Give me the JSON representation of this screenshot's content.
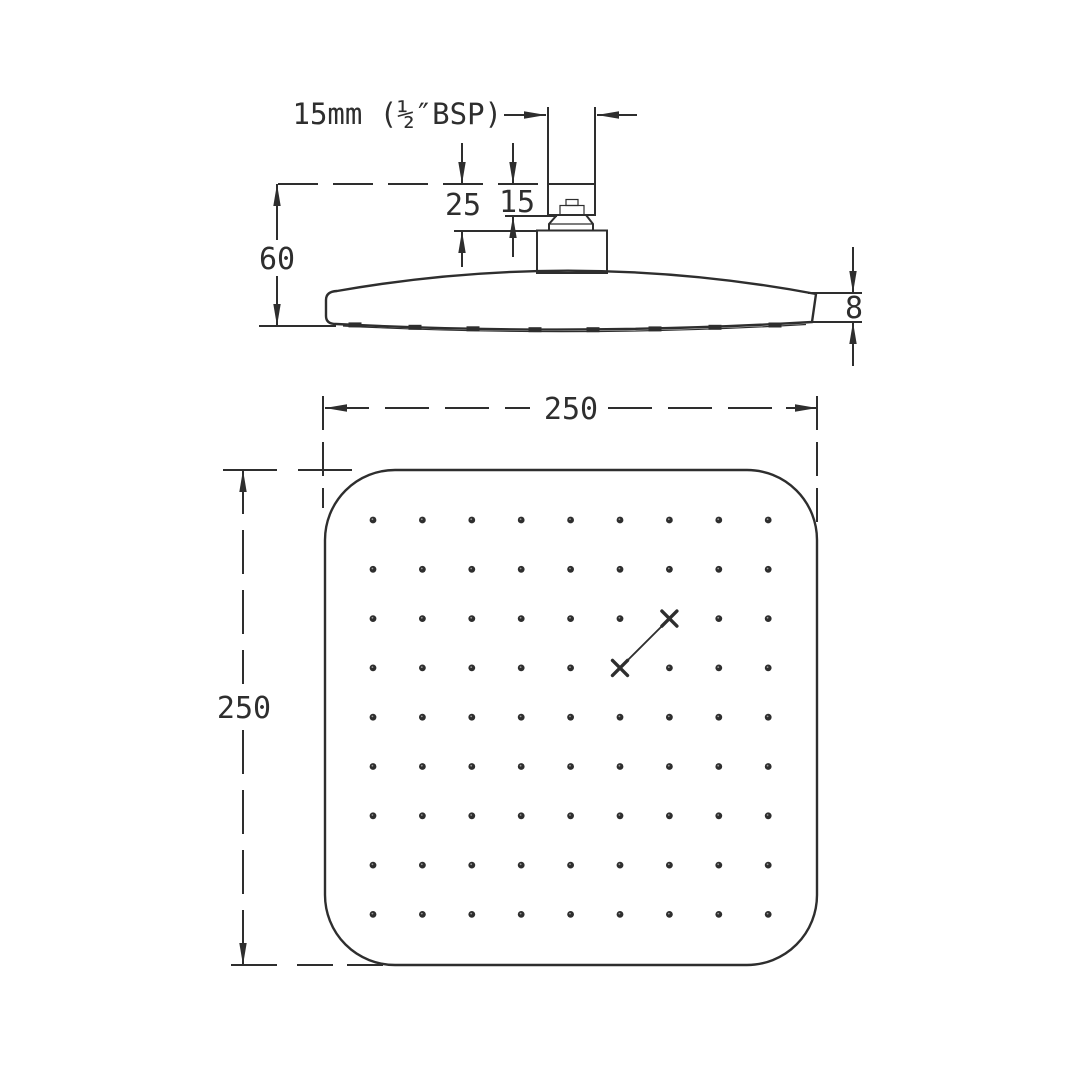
{
  "colors": {
    "line": "#2e2e2e",
    "background": "#ffffff"
  },
  "side_view": {
    "thread_label": "15mm (½″BSP)",
    "dim_thread_height": "15",
    "dim_connector_height": "25",
    "dim_head_height": "60",
    "dim_edge_thickness": "8"
  },
  "top_view": {
    "dim_width": "250",
    "dim_height": "250",
    "nozzle_grid": {
      "rows": 9,
      "cols": 9,
      "marked": [
        {
          "row": 3,
          "col": 7
        },
        {
          "row": 4,
          "col": 6
        }
      ]
    }
  }
}
